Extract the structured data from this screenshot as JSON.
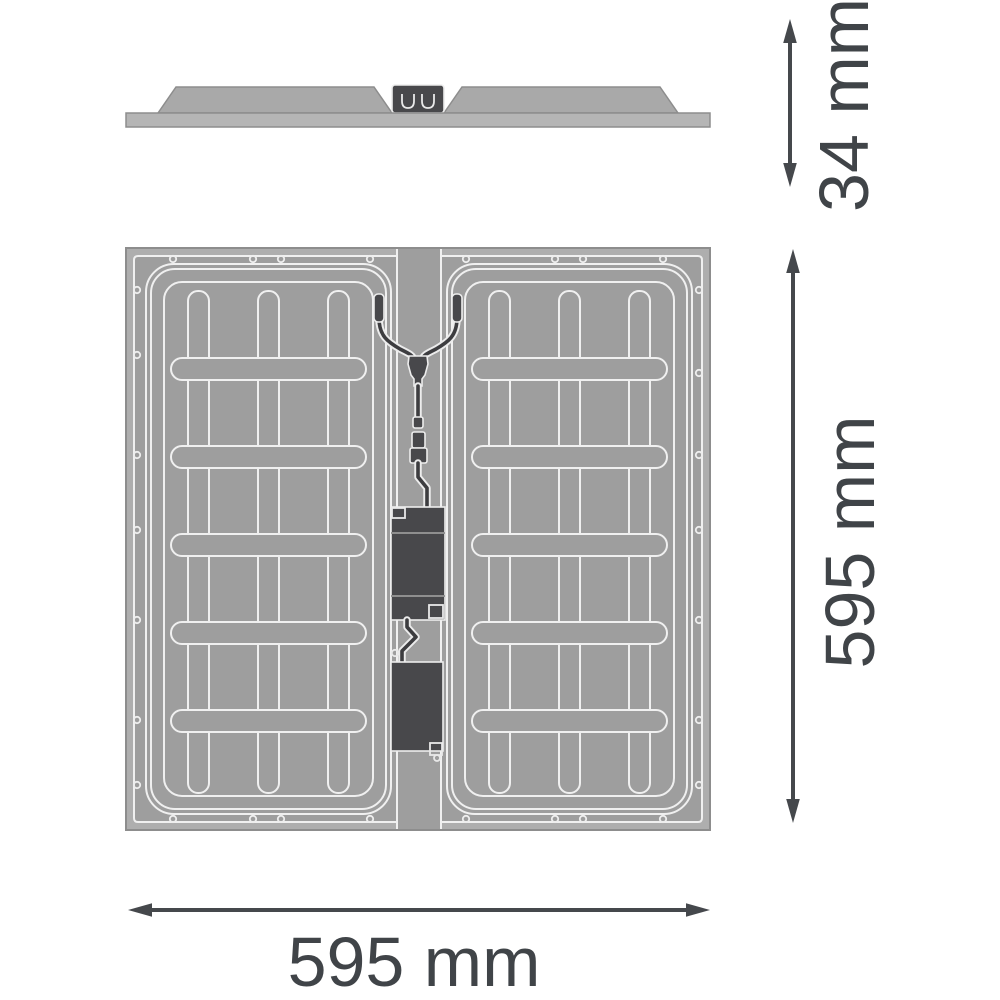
{
  "drawing": {
    "kind": "luminaire-dimension-drawing",
    "views": {
      "side_profile": {
        "description": "panel edge profile with surface-mounted housing and connector box",
        "dimension_label": "34 mm"
      },
      "back_view": {
        "description": "square panel rear with two embossed trays, centre cable channel, supply cable and two driver boxes",
        "width_dimension_label": "595 mm",
        "height_dimension_label": "595 mm"
      }
    },
    "labels": {
      "profile_height": "34 mm",
      "back_height": "595 mm",
      "back_width": "595 mm"
    },
    "colors": {
      "background": "#ffffff",
      "panel_band_gray": "#aeaeae",
      "panel_surface_gray": "#9e9e9e",
      "engraved_line": "#f0f0f0",
      "edge_outline": "#8d8d8d",
      "component_dark": "#48484b",
      "cable_dark": "#3d3d40",
      "dimension_ink": "#45484c"
    },
    "icons": {
      "vertical_double_arrow": "dimension-arrow-vertical",
      "horizontal_double_arrow": "dimension-arrow-horizontal"
    }
  }
}
